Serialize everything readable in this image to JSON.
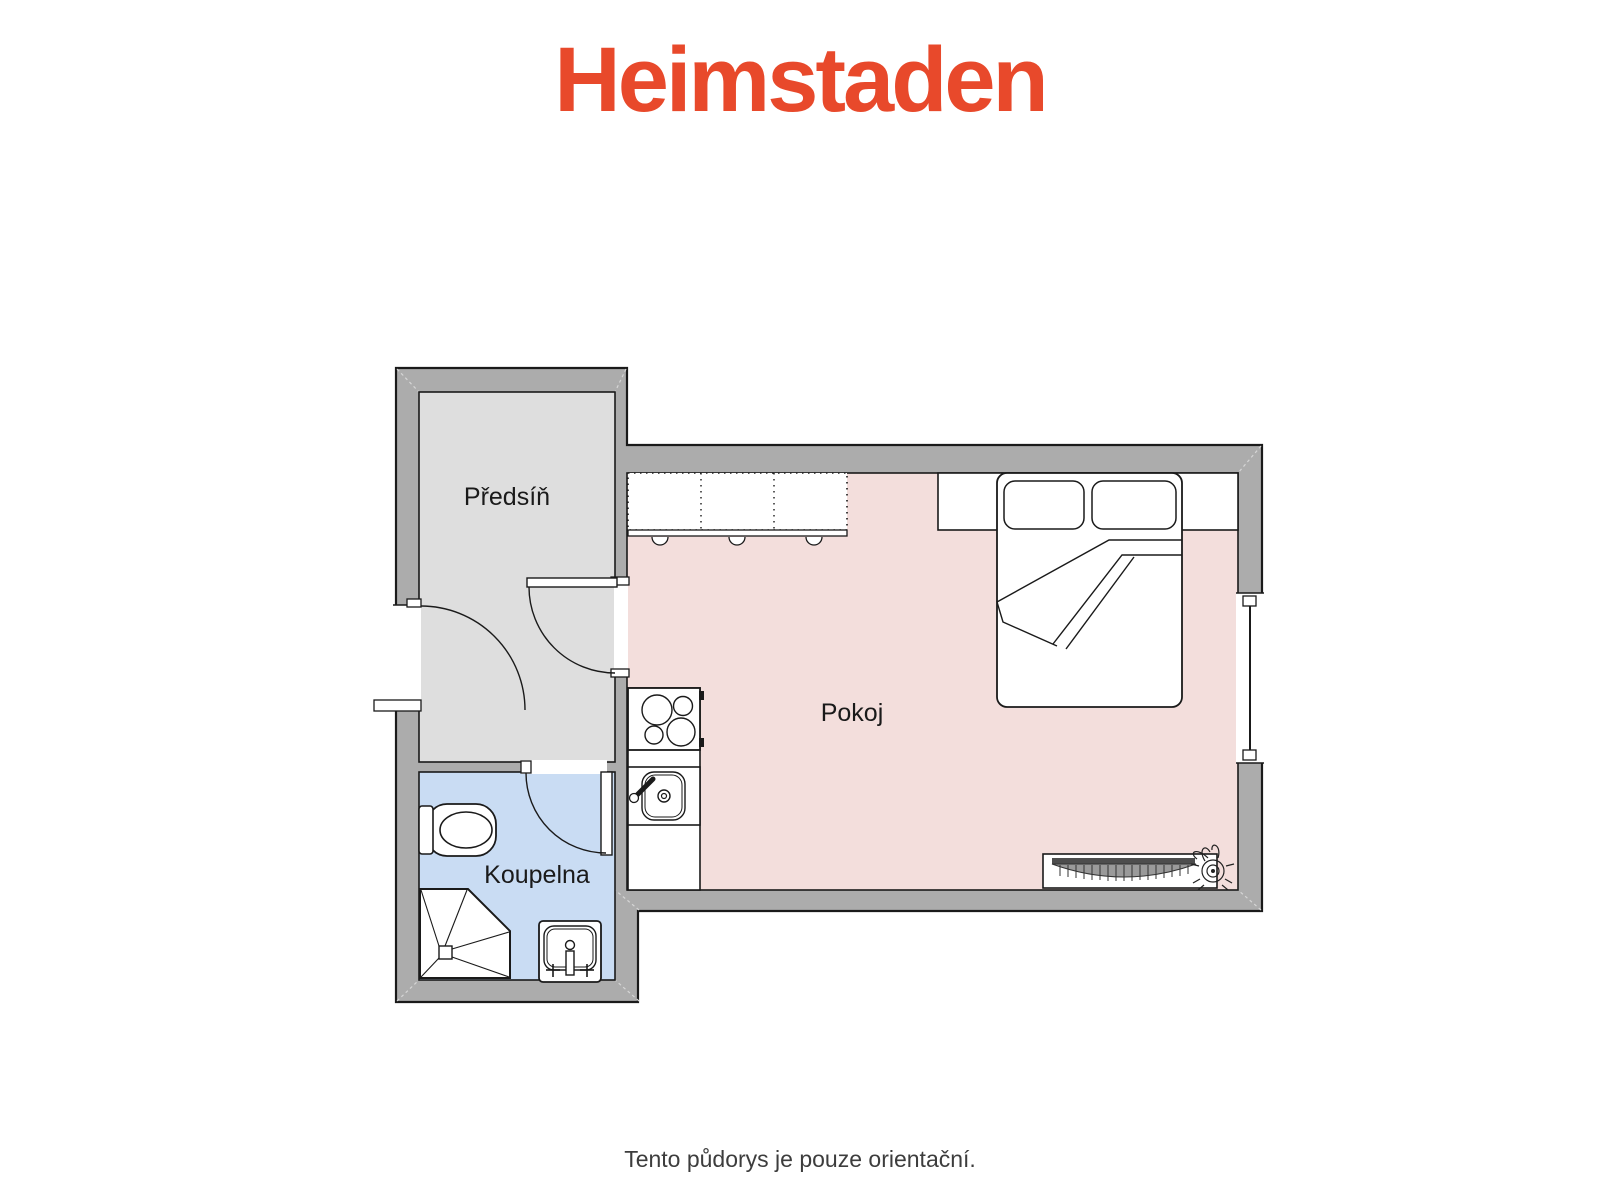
{
  "logo": {
    "text": "Heimstaden",
    "color": "#E8492B"
  },
  "floorplan": {
    "wall_color": "#ACACAC",
    "outline_color": "#1a1a1a",
    "rooms": [
      {
        "id": "predsin",
        "label": "Předsíň",
        "floor_color": "#DEDEDE"
      },
      {
        "id": "koupelna",
        "label": "Koupelna",
        "floor_color": "#C9DCF3"
      },
      {
        "id": "pokoj",
        "label": "Pokoj",
        "floor_color": "#F3DEDC"
      }
    ],
    "fixtures": [
      "kitchen-upper-cabinets",
      "kitchen-counter",
      "cooktop",
      "kitchen-sink",
      "double-bed",
      "wardrobe-shelf",
      "radiator",
      "plant-icon",
      "toilet",
      "corner-shower",
      "washbasin",
      "entrance-door",
      "door-pokoj",
      "door-koupelna",
      "window"
    ]
  },
  "caption": {
    "text": "Tento půdorys je pouze orientační.",
    "color": "#3d3d3d"
  }
}
